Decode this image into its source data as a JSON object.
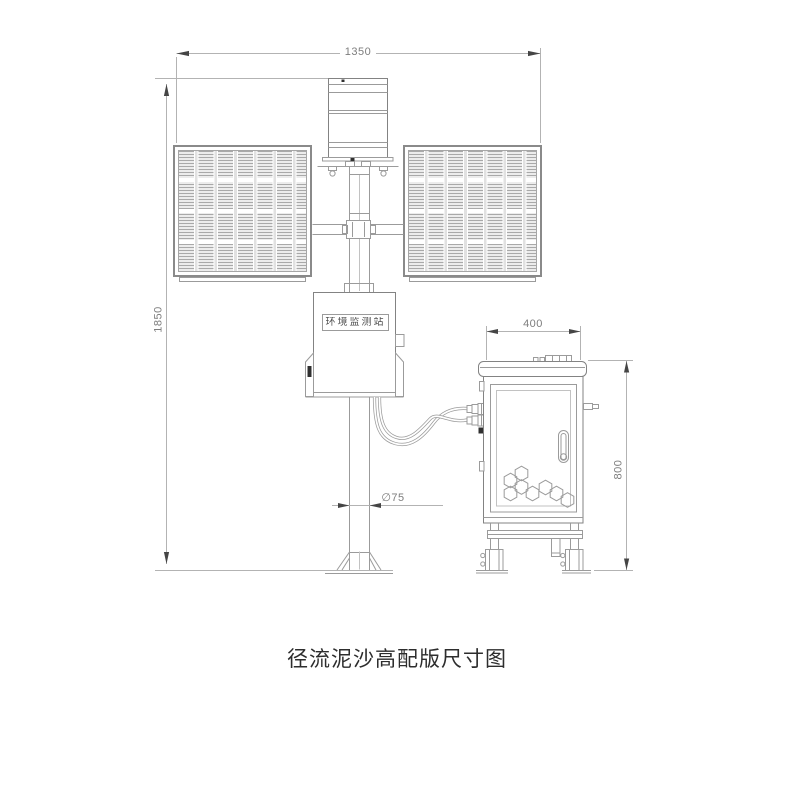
{
  "page": {
    "background": "#ffffff"
  },
  "title": {
    "text": "径流泥沙高配版尺寸图"
  },
  "station": {
    "nameplate": "环境监测站"
  },
  "dimensions": {
    "overall_width": "1350",
    "overall_height": "1850",
    "cabinet_width": "400",
    "cabinet_height": "800",
    "pole_diameter": "∅75"
  },
  "colors": {
    "line": "#9b9b9b",
    "dim_line": "#b3b3b3",
    "arrow": "#454545",
    "dim_text": "#7d7d7d",
    "nameplate_text": "#4f4f4f",
    "title_text": "#2d2d2d",
    "hatch": "#a9a9a9"
  }
}
